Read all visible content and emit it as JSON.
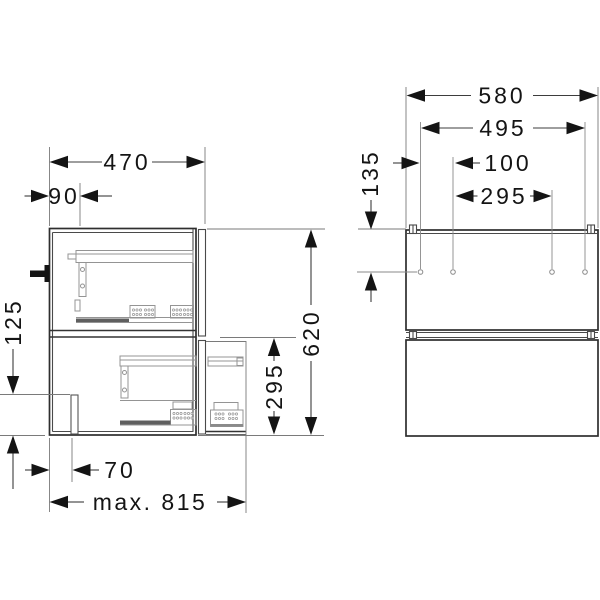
{
  "page": {
    "background": "#ffffff"
  },
  "drawing": {
    "kind": "vanity unit technical drawing, side and front views",
    "views": {
      "side": {
        "label": "side-view"
      },
      "front": {
        "label": "front-view"
      }
    },
    "dimensions": {
      "depth_total": "470",
      "back_offset": "90",
      "foot_height": "125",
      "drawer_height": "295",
      "height_total": "620",
      "foot_inset": "70",
      "width_max": "max. 815",
      "width_total": "580",
      "hole_span": "495",
      "hole_pitch_small": "100",
      "hole_pitch_large": "295",
      "hole_top_offset": "135"
    },
    "colors": {
      "outline": "#2e2e2e",
      "mechanism": "#949494",
      "dimension": "#3d3d3d",
      "extension": "#7a7a7a",
      "text": "#141414",
      "background": "#ffffff"
    }
  }
}
